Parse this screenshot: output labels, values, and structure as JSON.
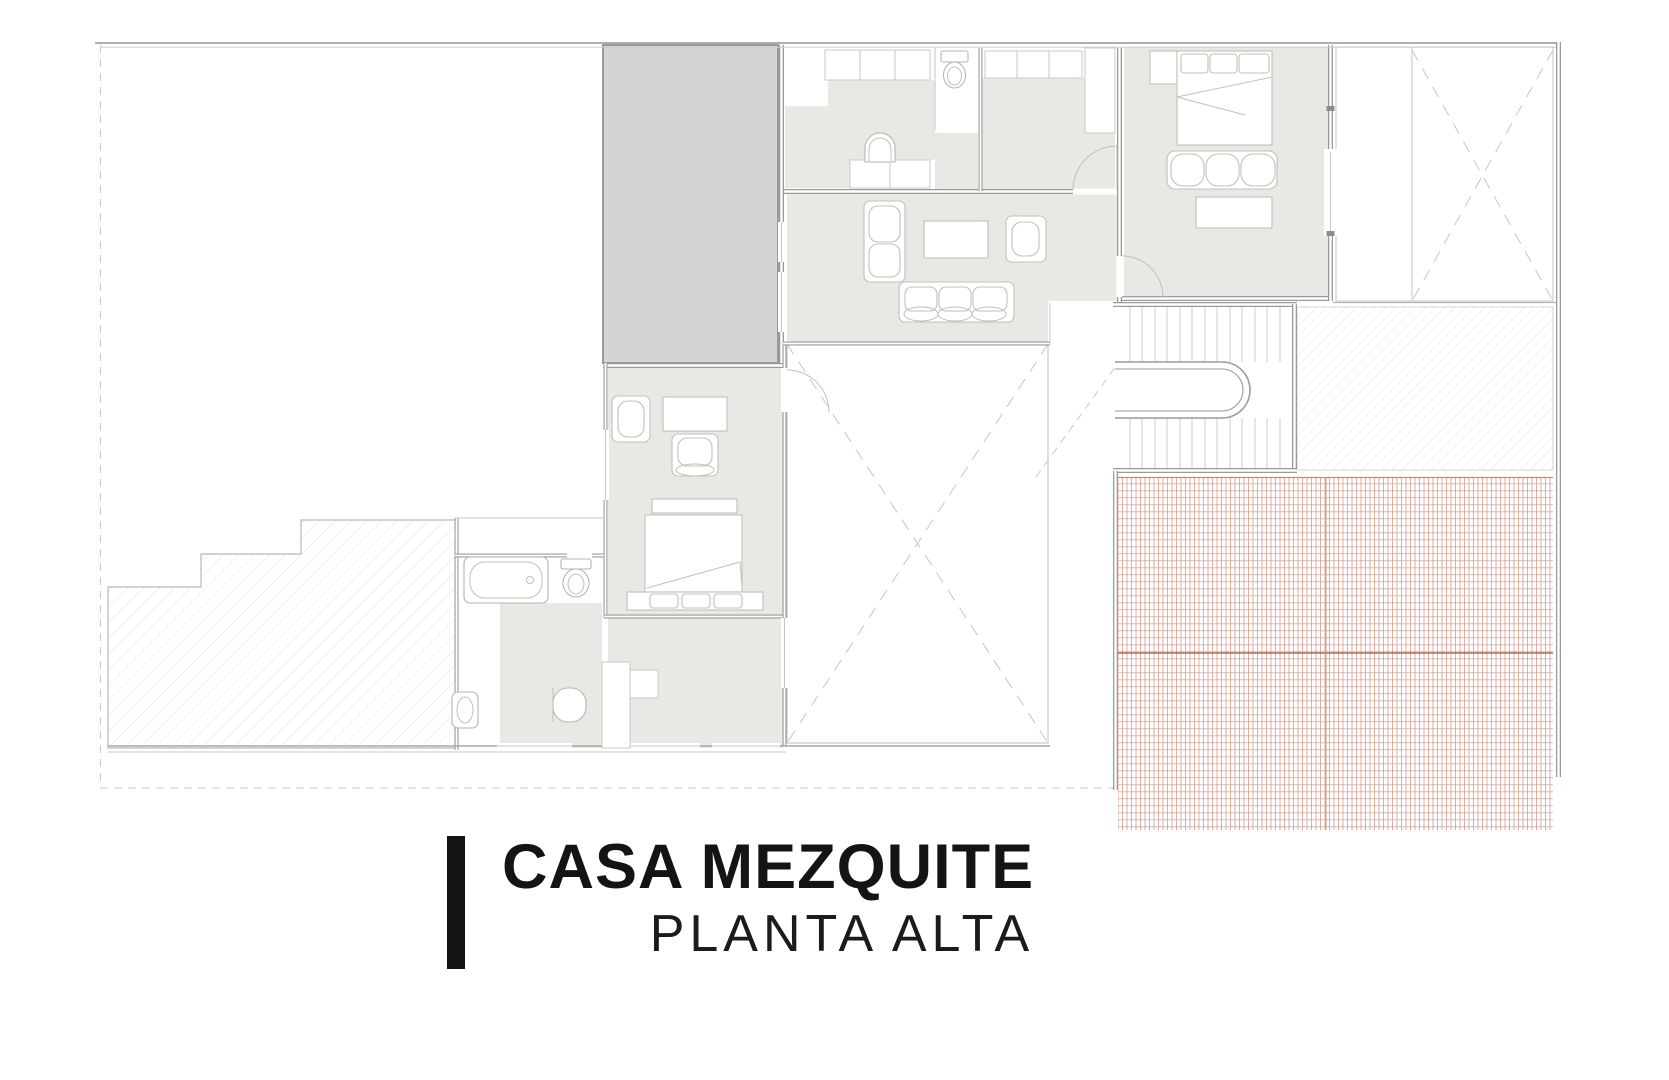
{
  "title_block": {
    "title": "CASA MEZQUITE",
    "subtitle": "PLANTA ALTA"
  },
  "palette": {
    "wall": "#9a9a9a",
    "thin_line": "#c6c6c6",
    "floor": "#e9e8e5",
    "dark_area": "#d4d4d3",
    "furniture_line": "#c2c0ba",
    "hatch_line": "#e4e1db",
    "roof_tile_line": "#d4a295",
    "roof_ridge_line": "#b4685a",
    "text": "#141414",
    "background": "#ffffff"
  }
}
